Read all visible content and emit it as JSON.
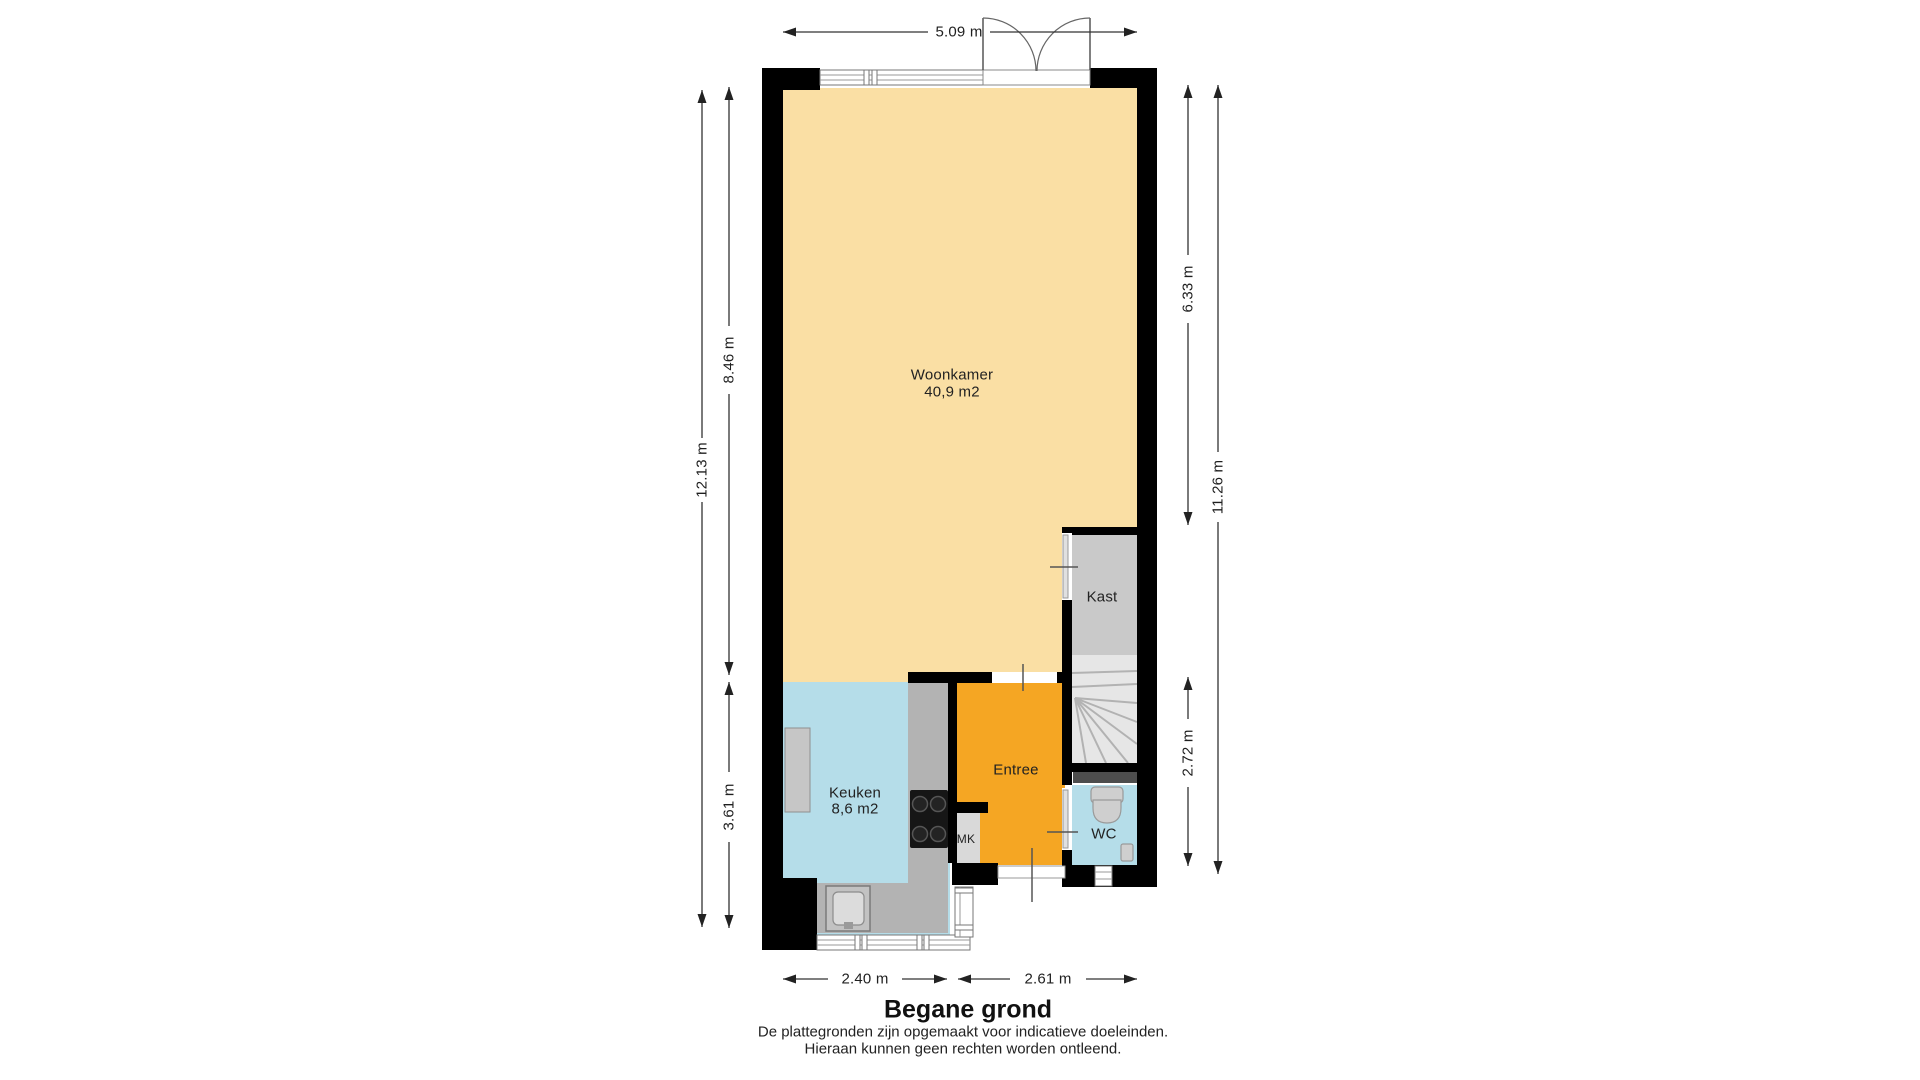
{
  "title": "Begane grond",
  "disclaimer": {
    "line1": "De plattegronden zijn opgemaakt voor indicatieve doeleinden.",
    "line2": "Hieraan kunnen geen rechten worden ontleend."
  },
  "rooms": {
    "woonkamer": {
      "name": "Woonkamer",
      "area": "40,9 m2"
    },
    "keuken": {
      "name": "Keuken",
      "area": "8,6 m2"
    },
    "entree": {
      "name": "Entree"
    },
    "kast": {
      "name": "Kast"
    },
    "mk": {
      "name": "MK"
    },
    "wc": {
      "name": "WC"
    }
  },
  "dimensions": {
    "top_width": "5.09 m",
    "left_total": "12.13 m",
    "left_upper": "8.46 m",
    "left_lower": "3.61 m",
    "right_upper": "6.33 m",
    "right_lower": "2.72 m",
    "right_total": "11.26 m",
    "bottom_left": "2.40 m",
    "bottom_right": "2.61 m"
  },
  "colors": {
    "floor-living": "#FADFA4",
    "floor-kitchen": "#B5DDE9",
    "floor-entry": "#F5A623",
    "floor-closet": "#C9C9C9",
    "floor-stairs": "#E6E6E6",
    "counter": "#B3B3B3",
    "counter-light": "#C6C6C6",
    "radiator": "#4D4D4D",
    "wall": "#000000",
    "dim-line": "#333333"
  }
}
